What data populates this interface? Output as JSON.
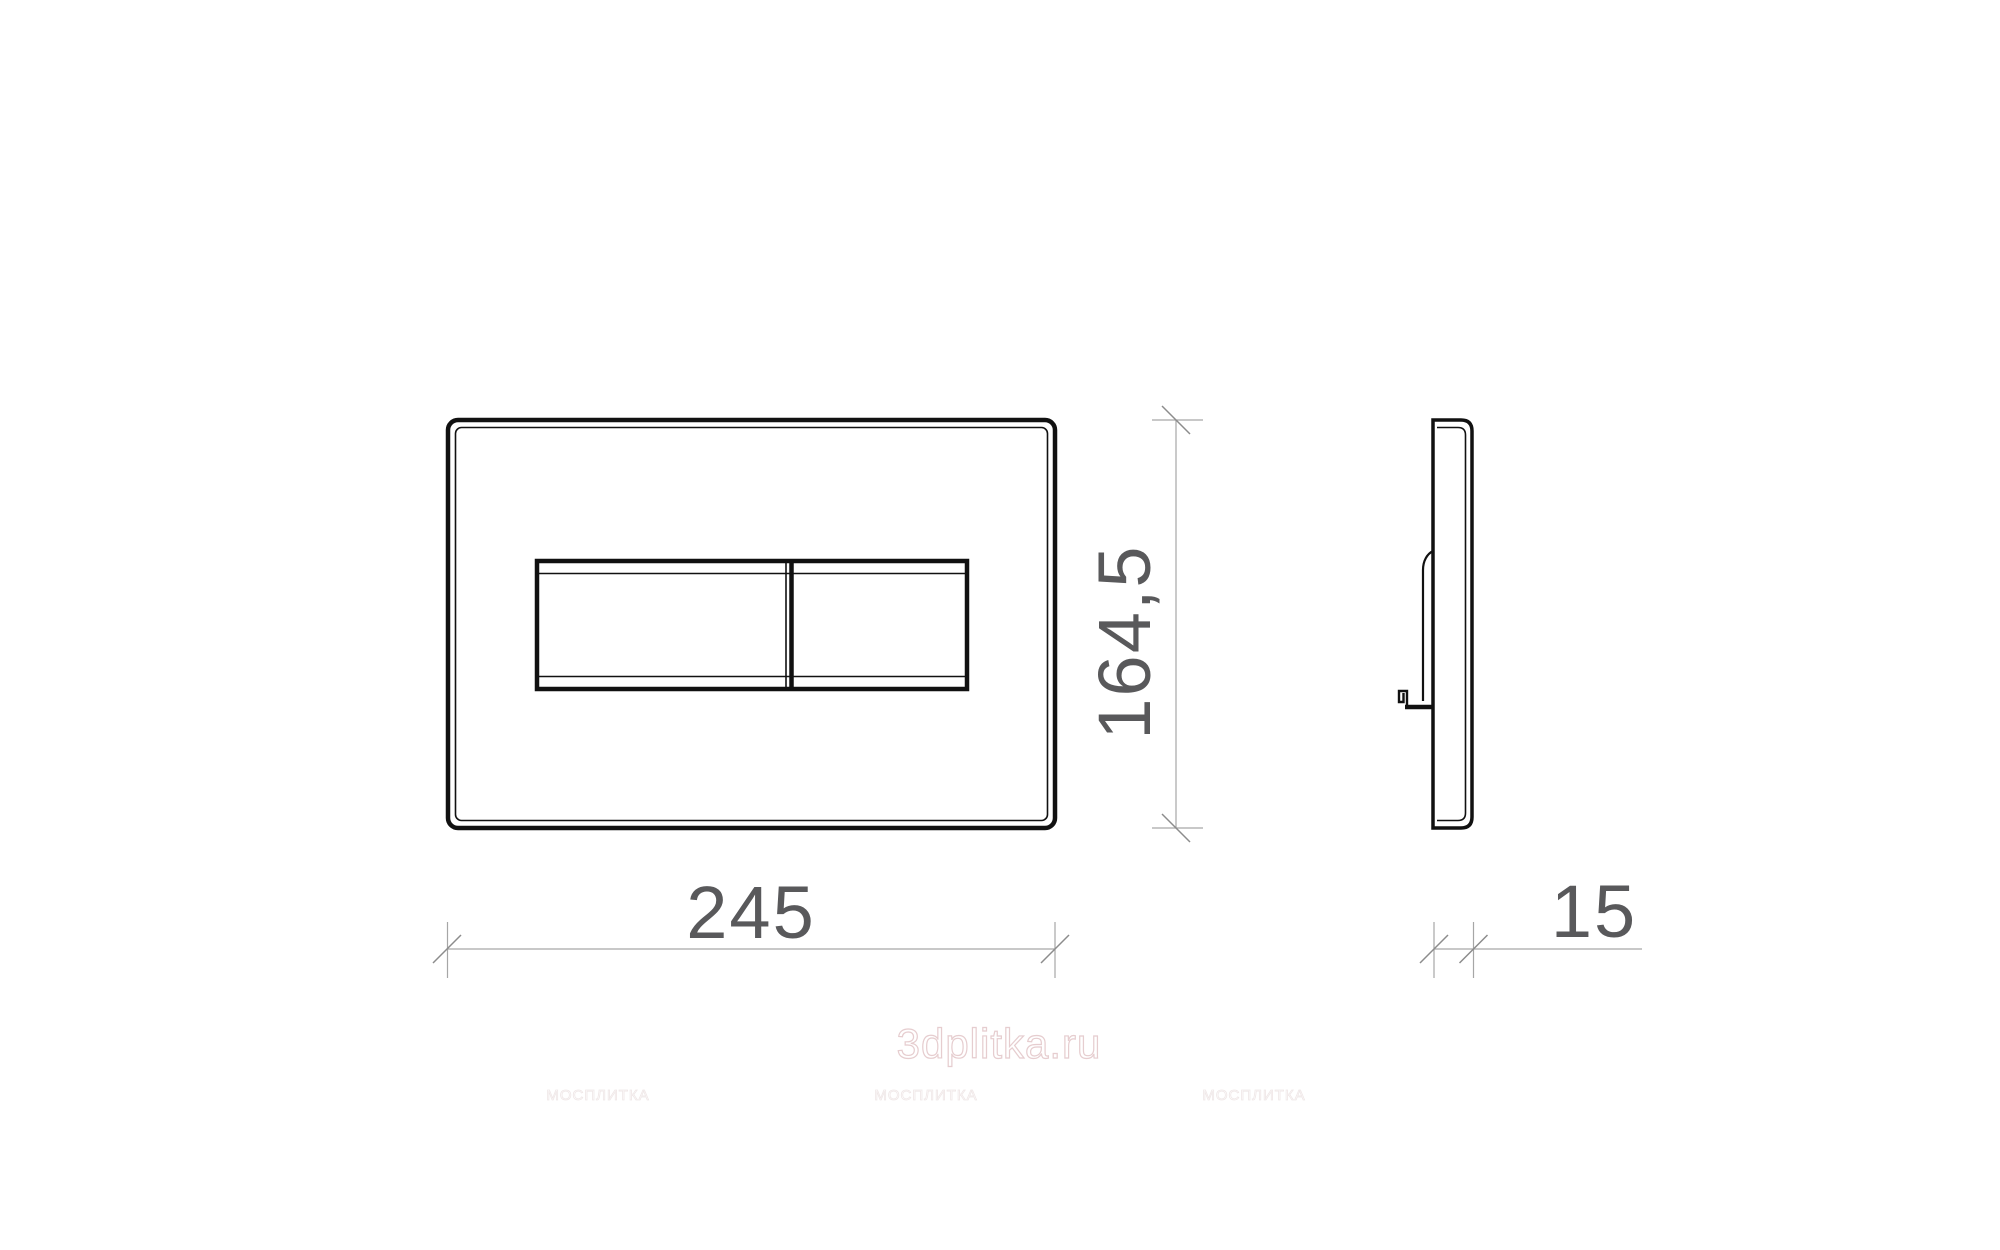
{
  "drawing": {
    "title": "flush-plate-technical-drawing",
    "dimensions": {
      "width_label": "245",
      "height_label": "164,5",
      "depth_label": "15"
    },
    "watermark": {
      "brand": "3dplitka.ru",
      "tile_marks": [
        "МОСПЛИТКА",
        "МОСПЛИТКА",
        "МОСПЛИТКА"
      ]
    },
    "colors": {
      "line_black": "#111111",
      "dim_gray": "#a6a6a6",
      "tick_gray": "#8c8c8c",
      "text_gray": "#59595b",
      "watermark_pink": "#e6cdcf",
      "watermark_faint": "#efe7e7"
    }
  }
}
